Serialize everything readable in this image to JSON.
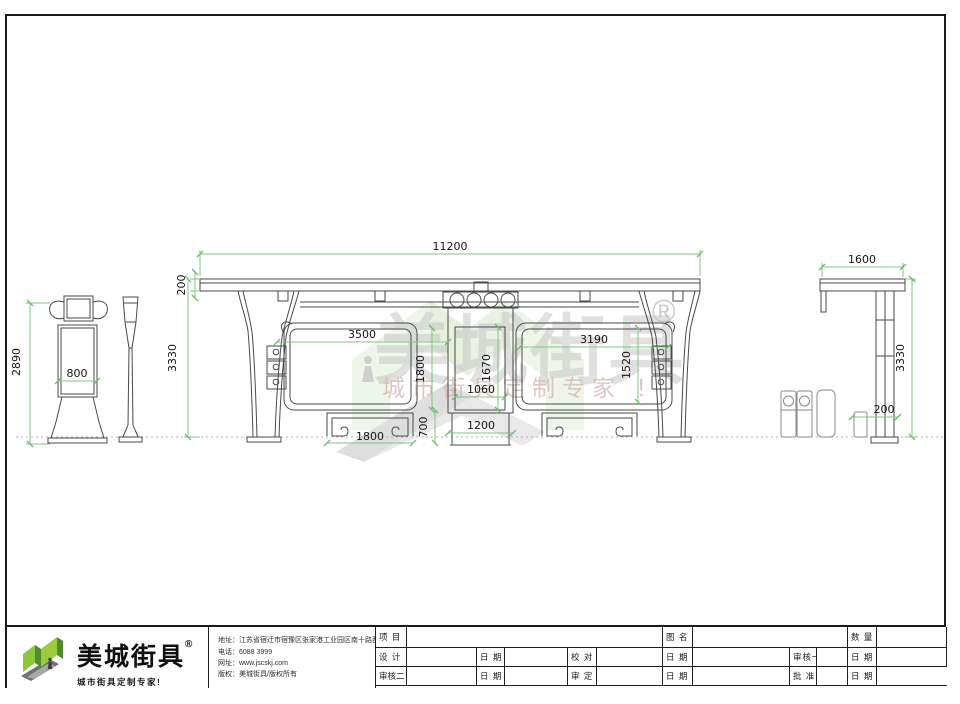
{
  "watermark": {
    "brand": "美城街具",
    "registered": "®",
    "slogan": "城市街具定制专家 ！"
  },
  "drawing": {
    "front_view": {
      "total_width": "11200",
      "roof_thickness": "200",
      "total_height": "3330",
      "left_panel_width": "3500",
      "left_panel_height": "1800",
      "center_panel_height": "1670",
      "center_panel_width": "1060",
      "right_panel_width": "3190",
      "right_panel_height": "1520",
      "bench_height": "700",
      "center_base_width": "1200",
      "bench_width": "1800"
    },
    "kiosk_view": {
      "total_height": "2890",
      "panel_width": "800"
    },
    "side_view": {
      "roof_depth": "1600",
      "total_height": "3330",
      "base_offset": "200"
    }
  },
  "footer": {
    "logo": {
      "brand": "美城街具",
      "registered": "®",
      "slogan": "城市街具定制专家!"
    },
    "company_info": {
      "address": "地址：江苏省宿迁市宿豫区张家港工业园区南十路西侧1号",
      "phone": "电话：6088 3999",
      "website": "网址：www.jscskj.com",
      "copyright": "版权：美城街具/版权所有"
    },
    "titleblock": {
      "row1": {
        "project": "项 目",
        "drawing_name": "图 名",
        "quantity": "数 量"
      },
      "row2": {
        "design": "设 计",
        "date_a": "日 期",
        "proofread": "校 对",
        "date_b": "日 期",
        "review1": "审核一",
        "date_c": "日 期"
      },
      "row3": {
        "review2": "审核二",
        "date_a": "日 期",
        "approval": "审 定",
        "date_b": "日 期",
        "ratify": "批 准",
        "date_c": "日 期"
      }
    }
  },
  "colors": {
    "dimension_green": "#7cc87c",
    "line_dark": "#4a4a4a",
    "logo_green": "#8dc63f",
    "logo_green_dark": "#4e8d2c",
    "logo_gray": "#6d6f72",
    "watermark_gray": "#c7c7c7",
    "watermark_pink": "#d6bab1"
  }
}
